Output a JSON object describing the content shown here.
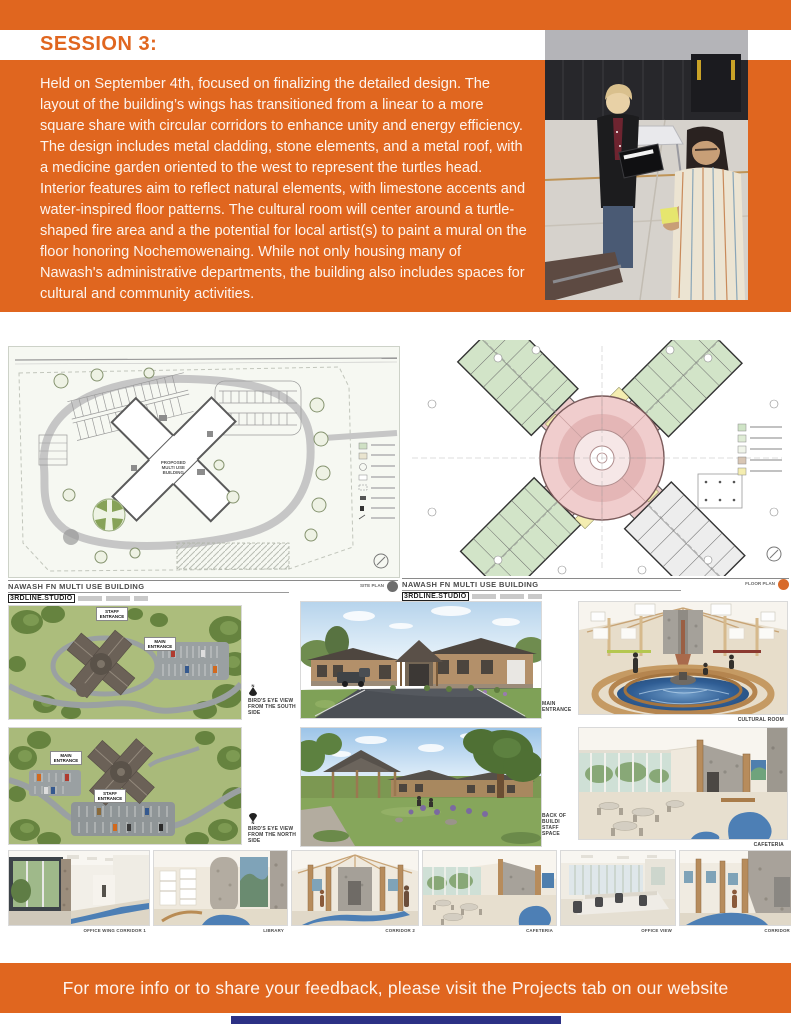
{
  "header": {
    "session_title": "SESSION 3:",
    "body": "Held on September 4th, focused on finalizing the detailed design. The layout of the building’s wings has transitioned from a linear to a more square share with circular corridors to enhance unity and energy efficiency. The design includes metal cladding, stone elements, and a metal roof, with a medicine garden oriented to the west to represent the turtles head. Interior features aim to reflect natural elements, with limestone accents and water-inspired floor patterns. The cultural room will center around a turtle-shaped fire area and a the potential for local artist(s) to paint a mural on the floor honoring Nochemowenaing. While not only housing many of Nawash's administrative departments, the building also includes spaces for cultural and community activities."
  },
  "plans": {
    "site_plan": {
      "project_title": "NAWASH FN MULTI USE BUILDING",
      "studio": "3RDLINE.STUDIO",
      "sheet_label": "SITE PLAN",
      "building_label": "PROPOSED MULTI USE BUILDING"
    },
    "floor_plan": {
      "project_title": "NAWASH FN MULTI USE BUILDING",
      "studio": "3RDLINE.STUDIO",
      "sheet_label": "FLOOR PLAN"
    }
  },
  "renders": {
    "aerial_south": {
      "label_staff": "STAFF ENTRANCE",
      "label_main": "MAIN ENTRANCE",
      "caption": "BIRD'S EYE VIEW FROM THE SOUTH SIDE",
      "compass": "N"
    },
    "aerial_north": {
      "label_main": "MAIN ENTRANCE",
      "label_staff": "STAFF ENTRANCE",
      "caption": "BIRD'S EYE VIEW FROM THE NORTH SIDE",
      "compass": "N"
    },
    "main_entrance": {
      "caption": "MAIN ENTRANCE"
    },
    "cultural_room": {
      "caption": "CULTURAL ROOM"
    },
    "back_of_building": {
      "caption_line1": "BACK OF BUILDI",
      "caption_line2": "STAFF SPACE"
    },
    "cafeteria": {
      "caption": "CAFETERIA"
    }
  },
  "thumbnails": [
    {
      "caption": "OFFICE WING CORRIDOR 1"
    },
    {
      "caption": "LIBRARY"
    },
    {
      "caption": "CORRIDOR 2"
    },
    {
      "caption": "CAFETERIA"
    },
    {
      "caption": "OFFICE VIEW"
    },
    {
      "caption": "CORRIDOR 3"
    }
  ],
  "footer": {
    "text": "For more info or to share your feedback, please visit the Projects tab on our website"
  },
  "colors": {
    "accent_orange": "#e0661f",
    "navy_bar": "#2c3185"
  }
}
